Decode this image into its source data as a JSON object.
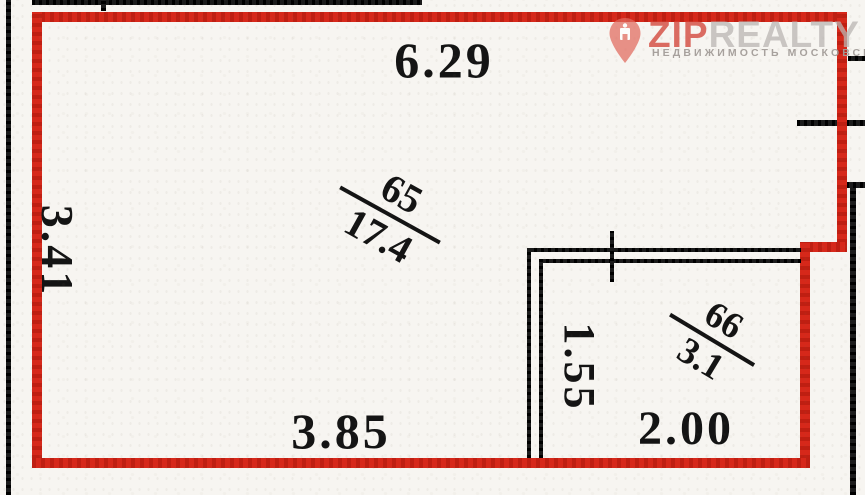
{
  "watermark": {
    "brand_zip": "ZIP",
    "brand_realty": "REALTY",
    "tagline": "НЕДВИЖИМОСТЬ МОСКОВСКОГО РЕГИОНА",
    "colors": {
      "pin": "#e26a5e",
      "zip": "#d4493e",
      "realty": "#bab6b3",
      "tagline": "#a39d99"
    }
  },
  "floorplan": {
    "colors": {
      "outline": "#d6281a",
      "walls": "#1b1b1b",
      "paper": "#f7f5f1",
      "ink": "#141414"
    },
    "rooms": [
      {
        "number": "65",
        "area": "17.4"
      },
      {
        "number": "66",
        "area": "3.1"
      }
    ],
    "dimensions": [
      {
        "label": "6.29",
        "position": "top"
      },
      {
        "label": "3.41",
        "position": "left"
      },
      {
        "label": "1.55",
        "position": "room-66-left"
      },
      {
        "label": "3.85",
        "position": "bottom-left"
      },
      {
        "label": "2.00",
        "position": "bottom-right"
      }
    ]
  }
}
